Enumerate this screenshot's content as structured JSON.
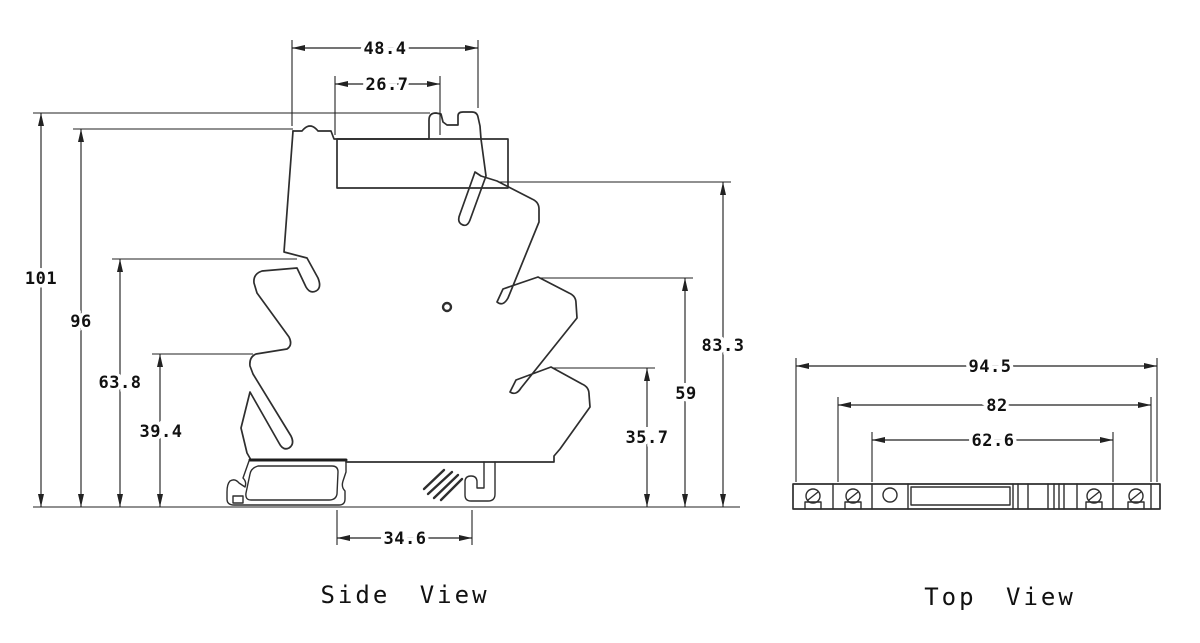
{
  "side_view": {
    "label": "Side View",
    "dims": {
      "top_width": "48.4",
      "socket_width": "26.7",
      "h_total": "101",
      "h_body": "96",
      "h_left_upper": "63.8",
      "h_left_lower": "39.4",
      "h_right_upper": "83.3",
      "h_right_mid": "59",
      "h_right_lower": "35.7",
      "foot_width": "34.6"
    }
  },
  "top_view": {
    "label": "Top View",
    "dims": {
      "overall_width": "94.5",
      "body_width": "82",
      "inner_width": "62.6"
    }
  },
  "line_color": "#2e2e2e"
}
